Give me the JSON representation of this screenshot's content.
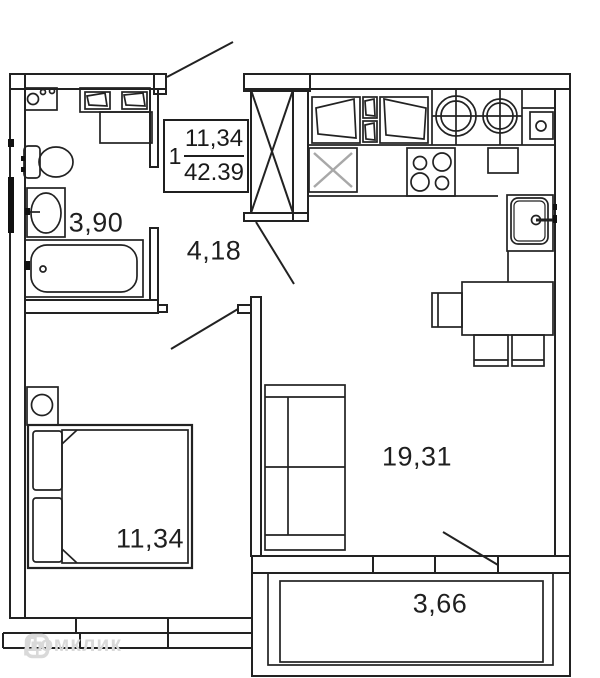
{
  "plan": {
    "info_box": {
      "unit_number": "1",
      "room_area": "11,34",
      "total_area": "42.39"
    },
    "labels": {
      "bathroom": "3,90",
      "hallway": "4,18",
      "bedroom": "11,34",
      "living_kitchen": "19,31",
      "balcony": "3,66"
    },
    "watermark": "Домклик",
    "colors": {
      "line": "#222222",
      "washer_x": "#a8a8a8",
      "watermark": "#d9d9d9"
    },
    "fixtures": [
      "bathtub",
      "washbasin",
      "toilet",
      "washer-unit",
      "wall-cabinets",
      "vent-shaft",
      "cooktop",
      "washing-machine-slot",
      "kitchen-sink",
      "boiler",
      "dining-table",
      "chairs",
      "sofa",
      "bed",
      "pillows",
      "nightstand-lamp",
      "entrance-door",
      "room-doors",
      "windows",
      "balcony"
    ]
  }
}
